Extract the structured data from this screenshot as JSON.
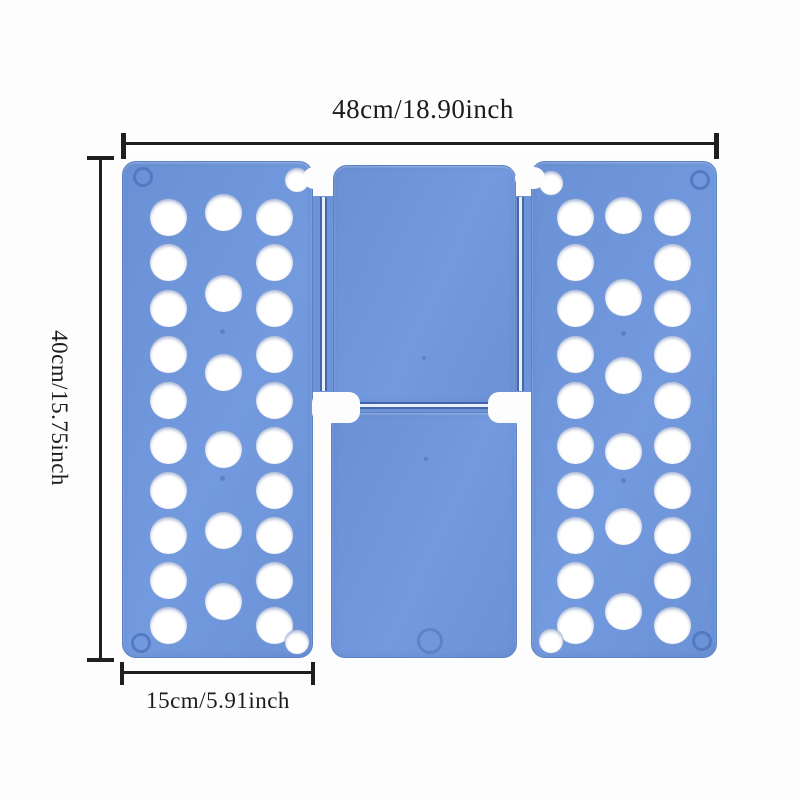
{
  "title": "Clothes folding board dimension image",
  "dimensions": {
    "width_label": "48cm/18.90inch",
    "height_label": "40cm/15.75inch",
    "panel_width_label": "15cm/5.91inch"
  },
  "colors": {
    "panel_blue": "#6e95da",
    "panel_edge": "#5a82c7",
    "groove_dark": "#3e5ea0",
    "groove_light": "#e9f0fc",
    "hole_white": "#ffffff",
    "annotation_black": "#1f1f1f",
    "background": "#fdfdfd"
  },
  "board": {
    "panels": [
      {
        "id": "left-panel",
        "x": 122,
        "y": 161,
        "w": 191,
        "h": 497,
        "columns_x": [
          168,
          223,
          274
        ],
        "outer_rows_y": [
          217,
          262,
          308,
          354,
          400,
          445,
          490,
          535,
          580,
          625
        ],
        "middle_rows_y": [
          212,
          293,
          372,
          449,
          530,
          601
        ],
        "hole_d": 37,
        "corner_hole_d": 24,
        "corner_holes": [
          {
            "x": 297,
            "y": 180
          },
          {
            "x": 297,
            "y": 642
          }
        ],
        "screw_rings": [
          {
            "x": 143,
            "y": 177
          },
          {
            "x": 141,
            "y": 643
          }
        ],
        "pin_dots": [
          {
            "x": 222,
            "y": 331
          },
          {
            "x": 222,
            "y": 478
          }
        ]
      },
      {
        "id": "right-panel",
        "x": 531,
        "y": 161,
        "w": 186,
        "h": 497,
        "columns_x": [
          575,
          623,
          672
        ],
        "outer_rows_y": [
          217,
          262,
          308,
          354,
          400,
          445,
          490,
          535,
          580,
          625
        ],
        "middle_rows_y": [
          215,
          297,
          375,
          451,
          526,
          611
        ],
        "hole_d": 37,
        "corner_hole_d": 24,
        "corner_holes": [
          {
            "x": 551,
            "y": 183
          },
          {
            "x": 551,
            "y": 641
          }
        ],
        "screw_rings": [
          {
            "x": 700,
            "y": 180
          },
          {
            "x": 702,
            "y": 641
          }
        ],
        "pin_dots": [
          {
            "x": 623,
            "y": 333
          },
          {
            "x": 623,
            "y": 480
          }
        ]
      }
    ],
    "center_top": {
      "x": 333,
      "y": 165,
      "w": 183,
      "h": 239
    },
    "center_bottom": {
      "x": 331,
      "y": 412,
      "w": 186,
      "h": 246,
      "ring_indent": {
        "x": 430,
        "y": 641,
        "d": 26
      }
    },
    "mold_dots": [
      {
        "x": 424,
        "y": 358
      },
      {
        "x": 426,
        "y": 459
      }
    ]
  }
}
